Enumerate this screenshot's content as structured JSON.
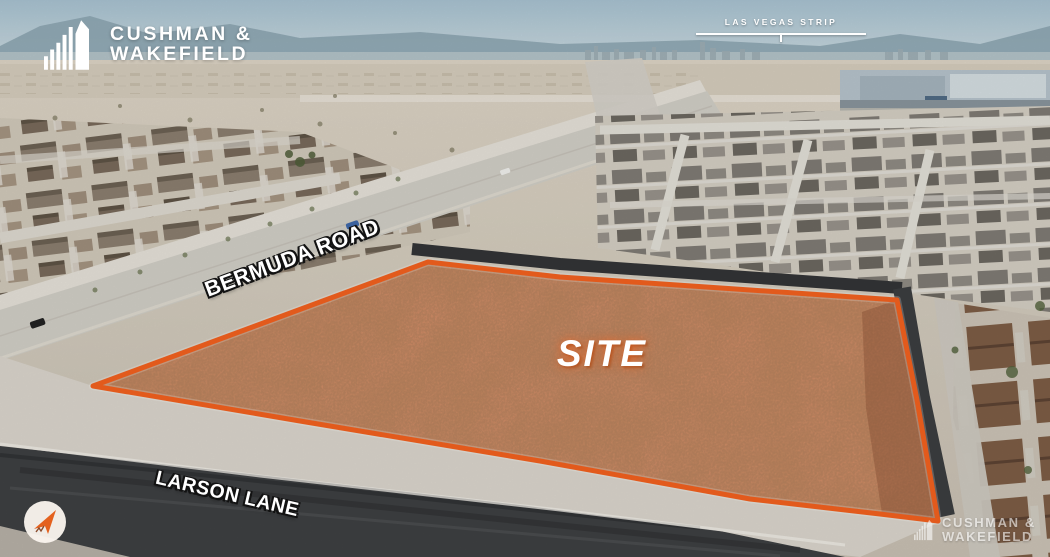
{
  "branding": {
    "logo": {
      "line1": "CUSHMAN &",
      "line2": "WAKEFIELD",
      "icon": "cushman-wakefield-buildings-icon"
    }
  },
  "callouts": {
    "skyline": {
      "label": "LAS VEGAS STRIP"
    },
    "site": {
      "label": "SITE"
    },
    "roads": {
      "bermuda": {
        "label": "BERMUDA ROAD"
      },
      "larson": {
        "label": "LARSON LANE"
      }
    }
  },
  "watermark": {
    "line1": "CUSHMAN &",
    "line2": "WAKEFIELD"
  },
  "compass": {
    "icon": "north-arrow-icon"
  },
  "colors": {
    "site_outline": "#F1601E",
    "site_tint": "#D9906B",
    "accent": "#F15A24"
  }
}
